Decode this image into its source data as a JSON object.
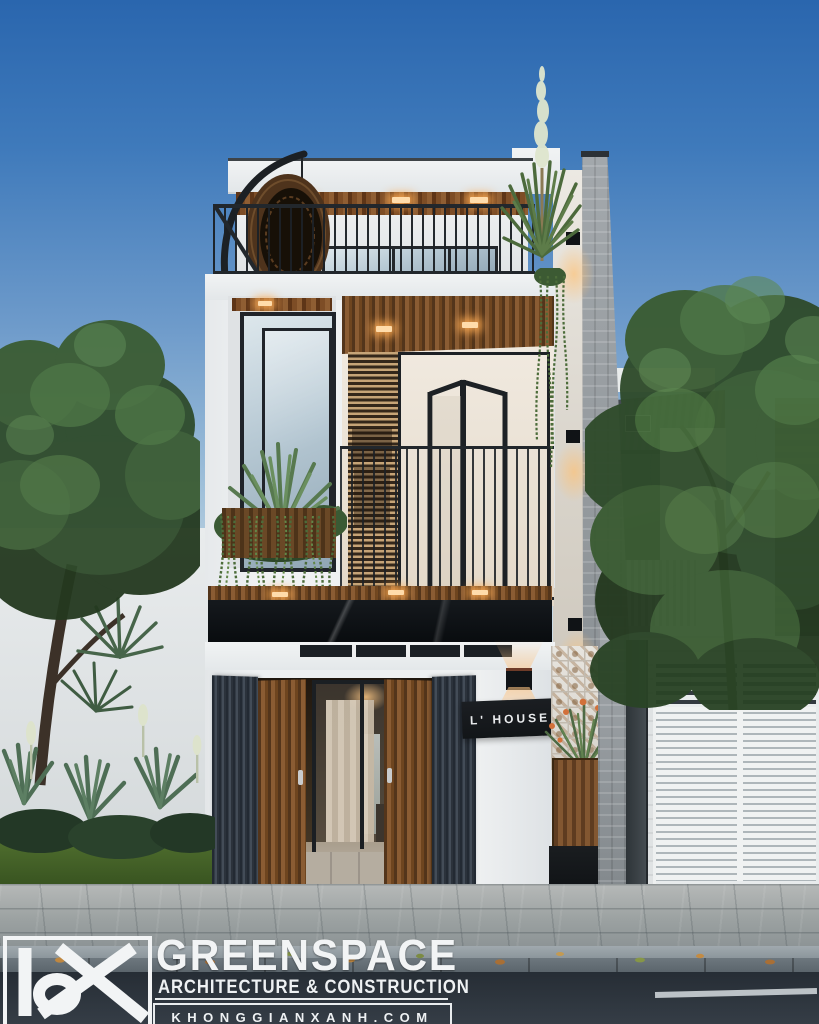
{
  "scene": {
    "alt": "Three-storey modern townhouse facade at dusk with rooftop terrace, wood bifold doors and garden",
    "sign": {
      "label": "L' HOUSE"
    },
    "branding": {
      "monogram_icon": "kgx-monogram",
      "name": "GREENSPACE",
      "tagline": "ARCHITECTURE & CONSTRUCTION",
      "website": "KHONGGIANXANH.COM"
    },
    "colors": {
      "sky_top": "#2e6cb4",
      "sky_horizon": "#c7d8e4",
      "facade_white": "#eff1f2",
      "wood": "#85552e",
      "frame_black": "#1e2226",
      "warm_light": "#ffb066",
      "foliage": "#3e5c38",
      "asphalt": "#2b323a"
    }
  }
}
